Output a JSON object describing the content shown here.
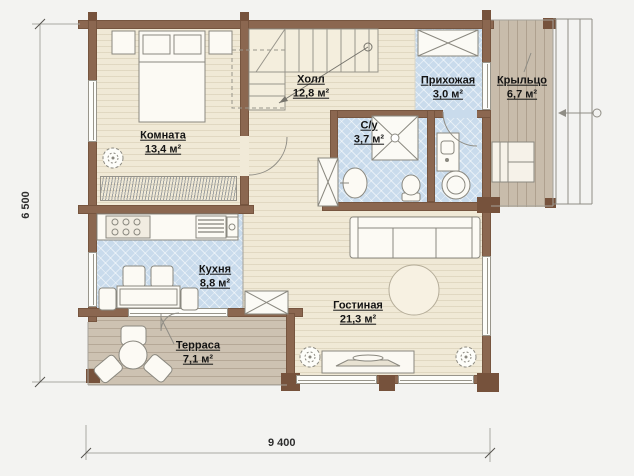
{
  "rooms": {
    "bedroom": {
      "name": "Комната",
      "area": "13,4 м²"
    },
    "hall": {
      "name": "Холл",
      "area": "12,8 м²"
    },
    "entry": {
      "name": "Прихожая",
      "area": "3,0 м²"
    },
    "porch": {
      "name": "Крыльцо",
      "area": "6,7 м²"
    },
    "bathroom": {
      "name": "С/у",
      "area": "3,7 м²"
    },
    "kitchen": {
      "name": "Кухня",
      "area": "8,8 м²"
    },
    "living": {
      "name": "Гостиная",
      "area": "21,3 м²"
    },
    "terrace": {
      "name": "Терраса",
      "area": "7,1 м²"
    }
  },
  "dimensions": {
    "total_width": "9 400",
    "total_depth": "6 500"
  },
  "colors": {
    "wall": "#8b6750",
    "wall_dark": "#76523c",
    "floor": "#f0e9d6",
    "wet_floor": "#c9dbec",
    "porch_deck": "#c8bcab",
    "terrace_deck": "#cdc2b2",
    "background": "#f3f3f1",
    "text": "#141414",
    "line": "#8f8d85"
  },
  "icons": {
    "bed-icon": "double bed with pillows",
    "nightstand-icon": "bedside table",
    "stairs-icon": "staircase with direction arrow",
    "plant-icon": "potted plant",
    "radiator-icon": "hatched radiator band",
    "wardrobe-icon": "crossed storage box",
    "cabinet-icon": "crossed storage box",
    "shower-icon": "shower cabin",
    "sink-icon": "wash basin",
    "toilet-icon": "toilet",
    "washbasin-cabinet-icon": "vanity with basin",
    "washing-machine-icon": "washing machine",
    "stove-icon": "cooktop",
    "sink-unit-icon": "sink with drainer",
    "kitchen-counter-icon": "kitchen counter",
    "dining-table-icon": "dining table with chairs",
    "terrace-set-icon": "round table with three chairs",
    "porch-bench-icon": "porch bench",
    "sofa-icon": "three-seat sofa",
    "round-rug-icon": "round rug",
    "tv-stand-icon": "tv console",
    "porch-steps-icon": "entrance steps with arrow",
    "door-arc": "door swing arc",
    "dimension-lines": "dimension lines with ticks"
  }
}
